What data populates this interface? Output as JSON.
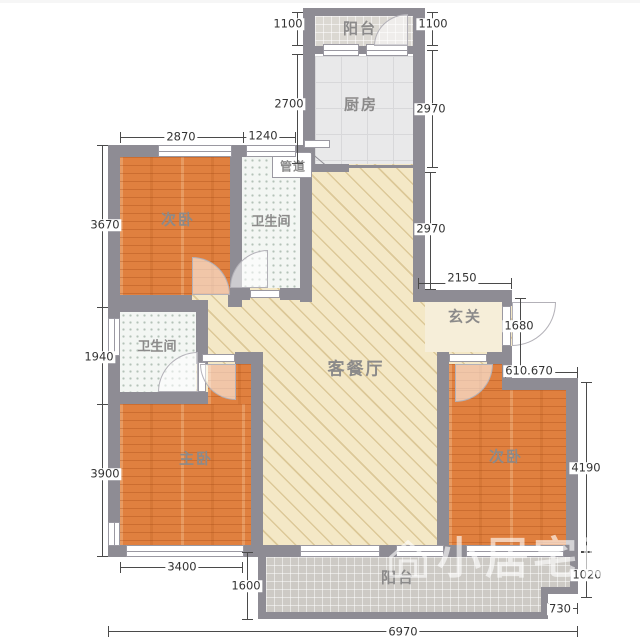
{
  "rooms": {
    "balcony_top": "阳台",
    "kitchen": "厨房",
    "duct": "管道",
    "bedroom_top_left": "次卧",
    "bathroom_top": "卫生间",
    "bathroom_mid": "卫生间",
    "living_dining": "客餐厅",
    "entry": "玄关",
    "master_bedroom": "主卧",
    "bedroom_right": "次卧",
    "balcony_bottom": "阳台"
  },
  "dimensions": {
    "balcony_top_left": "1100",
    "balcony_top_right": "1100",
    "kitchen_left": "2700",
    "kitchen_right": "2970",
    "bedroom_tl_width": "2870",
    "bathroom_top_width": "1240",
    "bedroom_tl_height": "3670",
    "living_upper_right": "2970",
    "entry_width": "2150",
    "entry_door": "1680",
    "bathroom_mid_height": "1940",
    "bedroom_right_offset": "610.670",
    "master_height": "3900",
    "bedroom_right_height": "4190",
    "master_width": "3400",
    "balcony_depth": "1600",
    "bedroom_right_gap": "1020",
    "balcony_step": "730",
    "total_width": "6970"
  },
  "watermark": {
    "text": "小居宅配"
  },
  "colors": {
    "wall": "#8e8c94",
    "wood_floor": "#e0803f",
    "living_floor": "#f4e8c6",
    "kitchen_floor": "#e9e9ea",
    "balcony_tile": "#cdcac5",
    "dimension_text": "#333333",
    "room_label_text": "#8b8a8a"
  }
}
